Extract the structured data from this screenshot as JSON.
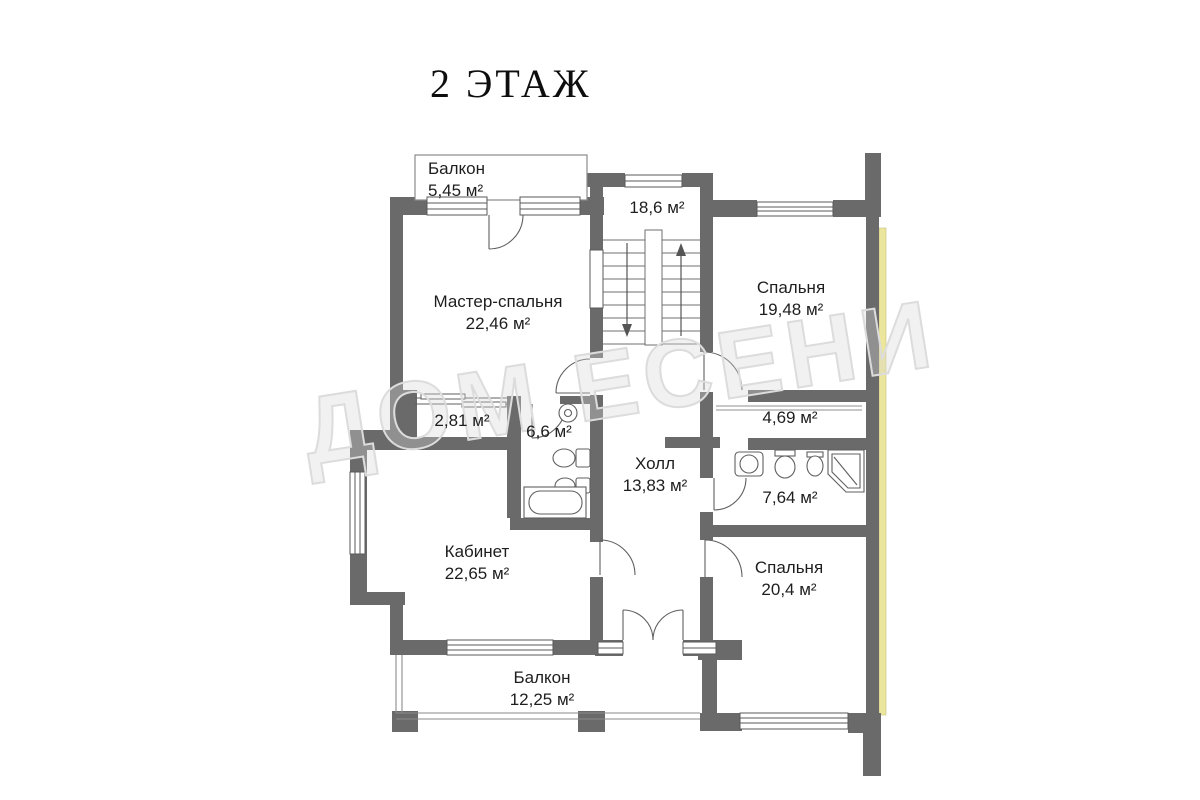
{
  "title": "2 ЭТАЖ",
  "watermark_text": "ДОМ ЕСЕНИ",
  "colors": {
    "wall": "#6a6a6a",
    "insulation_strip": "#ece59c",
    "label_text": "#1e1e1e",
    "watermark": "#dcdcdc"
  },
  "rooms": {
    "balcony_top": {
      "name": "Балкон",
      "area": "5,45 м²"
    },
    "stairwell": {
      "area": "18,6 м²"
    },
    "master_bedroom": {
      "name": "Мастер-спальня",
      "area": "22,46 м²"
    },
    "bedroom_upper": {
      "name": "Спальня",
      "area": "19,48 м²"
    },
    "closet": {
      "area": "2,81 м²"
    },
    "bathroom_small": {
      "area": "6,6 м²"
    },
    "wardrobe": {
      "area": "4,69 м²"
    },
    "hall": {
      "name": "Холл",
      "area": "13,83 м²"
    },
    "bathroom_large": {
      "area": "7,64 м²"
    },
    "office": {
      "name": "Кабинет",
      "area": "22,65 м²"
    },
    "bedroom_lower": {
      "name": "Спальня",
      "area": "20,4 м²"
    },
    "balcony_bottom": {
      "name": "Балкон",
      "area": "12,25 м²"
    }
  }
}
